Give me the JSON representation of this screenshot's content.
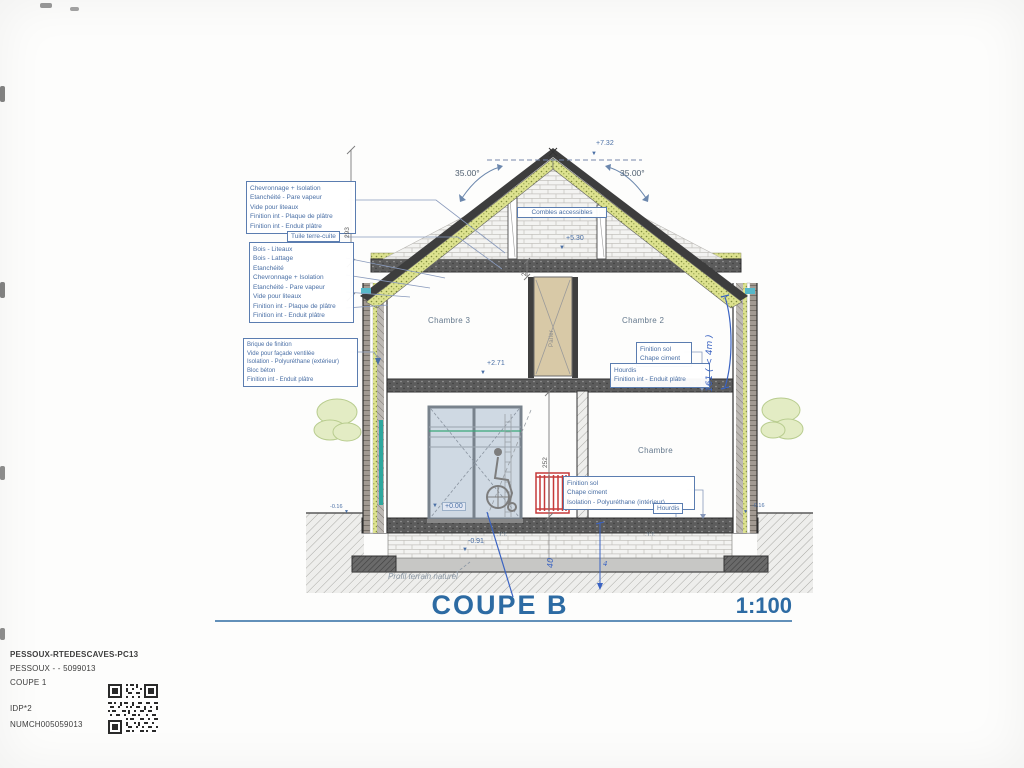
{
  "drawing": {
    "title": "COUPE B",
    "scale": "1:100",
    "terrain_label": "Profil terrain naturel"
  },
  "angles": {
    "left": "35.00°",
    "right": "35.00°"
  },
  "levels": {
    "ridge": "+7.32",
    "attic_floor": "+5.30",
    "first_floor": "+2.71",
    "ground_floor": "+0.00",
    "footing": "-0.91",
    "grade_left": "-0.16",
    "grade_right": "-0.16"
  },
  "rooms": {
    "attic": "Combles accessibles",
    "bedroom3": "Chambre 3",
    "bedroom2": "Chambre 2",
    "bedroom1": "Chambre",
    "landing": "Palier"
  },
  "callouts": {
    "roof_buildup": {
      "lines": [
        "Chevronnage + Isolation",
        "Etanchéité - Pare vapeur",
        "Vide pour liteaux",
        "Finition int - Plaque de plâtre",
        "Finition int - Enduit plâtre"
      ]
    },
    "tile": "Tuile terre-cuite",
    "eave_buildup": {
      "lines": [
        "Bois - Liteaux",
        "Bois - Lattage",
        "Etanchéité",
        "Chevronnage + Isolation",
        "Etanchéité - Pare vapeur",
        "Vide pour liteaux",
        "Finition int - Plaque de plâtre",
        "Finition int - Enduit plâtre"
      ]
    },
    "wall_buildup": {
      "lines": [
        "Brique de finition",
        "Vide pour façade ventilée",
        "Isolation - Polyuréthane (extérieur)",
        "Bloc béton",
        "Finition int - Enduit plâtre"
      ]
    },
    "first_floor_buildup": {
      "lines": [
        "Finition sol",
        "Chape ciment"
      ]
    },
    "first_floor_slab": {
      "lines": [
        "Hourdis",
        "Finition int - Enduit plâtre"
      ]
    },
    "ground_floor_buildup": {
      "lines": [
        "Finition sol",
        "Chape ciment",
        "Isolation - Polyuréthane (intérieur)"
      ]
    },
    "ground_floor_slab": {
      "lines": [
        "Hourdis"
      ]
    },
    "rebar_mark": ".Y.Y."
  },
  "dimensions": {
    "roof_height": "293",
    "slab_thickness": "24",
    "storey_height": "252"
  },
  "handwritten": {
    "right_note": "161 ( < 4m )",
    "depth_note": "40",
    "small_note": "4"
  },
  "titleblock": {
    "line1": "PESSOUX-RTEDESCAVES-PC13",
    "line2": "PESSOUX -  - 5099013",
    "line3": "COUPE 1",
    "line4": "IDP*2",
    "line5": "NUMCH005059013"
  },
  "colors": {
    "annotation_blue": "#4a6fa5",
    "title_blue": "#2d6ba3",
    "insulation_yellow": "#dde291",
    "radiator_red": "#cc4040",
    "handwriting_blue": "#3a63c2"
  }
}
